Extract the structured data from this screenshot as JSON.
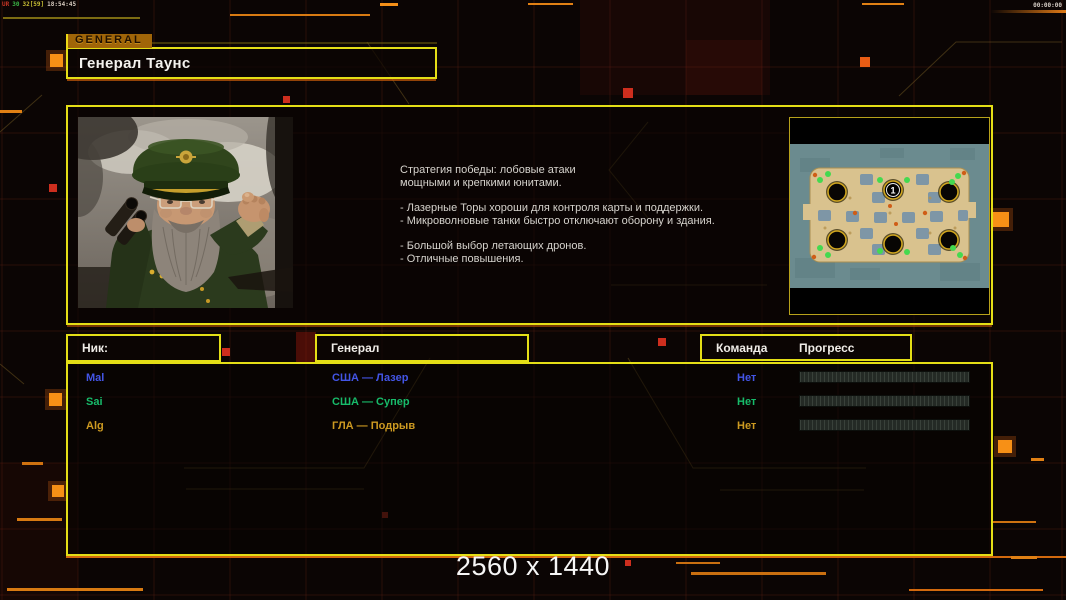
{
  "hud": {
    "debug_segments": [
      {
        "text": "UR",
        "color": "#c23424"
      },
      {
        "text": "30",
        "color": "#3ab446"
      },
      {
        "text": "32[59]",
        "color": "#c6bd34"
      },
      {
        "text": "18:54:45",
        "color": "#d8ccc0"
      }
    ],
    "match_timer": "00:00:00"
  },
  "header": {
    "tab_label": "GENERAL",
    "title": "Генерал Таунс"
  },
  "briefing": {
    "paragraphs": [
      [
        "Стратегия победы: лобовые атаки",
        "мощными и крепкими юнитами."
      ],
      [
        "- Лазерные Торы хороши для контроля карты и поддержки.",
        "- Микроволновые танки быстро отключают оборону и здания."
      ],
      [
        "- Большой выбор летающих дронов.",
        "- Отличные повышения."
      ]
    ],
    "minimap": {
      "start_position_label": "1"
    }
  },
  "table": {
    "headers": {
      "nick": "Ник:",
      "general": "Генерал",
      "team": "Команда",
      "progress": "Прогресс"
    },
    "rows": [
      {
        "nick": "Mal",
        "general": "США — Лазер",
        "team": "Нет",
        "progress_percent": 0,
        "color": "#4355e6"
      },
      {
        "nick": "Sai",
        "general": "США — Супер",
        "team": "Нет",
        "progress_percent": 0,
        "color": "#17bb6a"
      },
      {
        "nick": "Alg",
        "general": "ГЛА — Подрыв",
        "team": "Нет",
        "progress_percent": 0,
        "color": "#cd9a21"
      }
    ]
  },
  "footer": {
    "resolution": "2560 x 1440"
  },
  "colors": {
    "frame_yellow": "#e4de16",
    "accent_orange": "#e07c12",
    "alert_red": "#cd2e1e",
    "background": "#0b0504"
  }
}
